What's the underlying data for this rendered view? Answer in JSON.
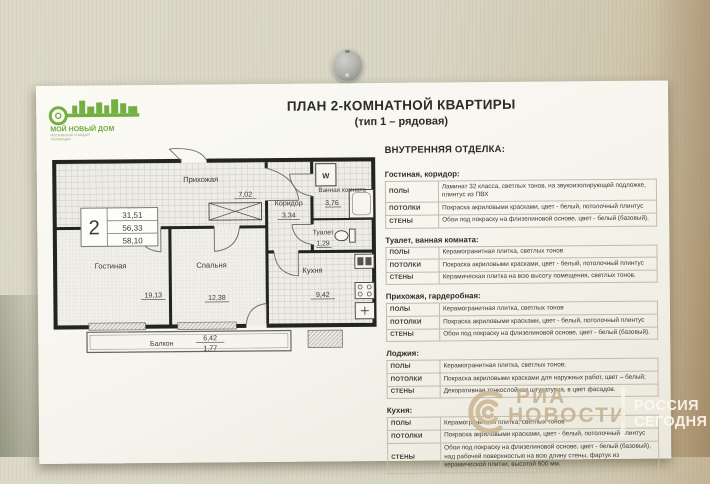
{
  "photo": {
    "watermark_left": {
      "line1": "РИА",
      "line2": "НОВОСТИ"
    },
    "watermark_right": {
      "line1": "РОССИЯ",
      "line2": "СЕГОДНЯ"
    }
  },
  "poster": {
    "logo": {
      "title": "МОЙ НОВЫЙ ДОМ",
      "subtitle_line1": "МОСКОВСКИЙ СТАНДАРТ",
      "subtitle_line2": "РЕНОВАЦИИ"
    },
    "title": "ПЛАН 2-КОМНАТНОЙ КВАРТИРЫ",
    "subtitle": "(тип 1 – рядовая)"
  },
  "plan": {
    "info_box": {
      "rooms": "2",
      "areas": [
        "31,51",
        "56,33",
        "58,10"
      ]
    },
    "washer_label": "W",
    "rooms": {
      "hallway": {
        "name": "Прихожая",
        "area": "7,02"
      },
      "corridor": {
        "name": "Коридор",
        "area": "3,34"
      },
      "bathroom": {
        "name": "Ванная комната",
        "area": "3,76"
      },
      "toilet": {
        "name": "Туалет",
        "area": "1,29"
      },
      "kitchen": {
        "name": "Кухня",
        "area": "9,42"
      },
      "living_room": {
        "name": "Гостиная",
        "area": "19,13"
      },
      "bedroom": {
        "name": "Спальня",
        "area": "12,38"
      },
      "balcony": {
        "name": "Балкон",
        "area_top": "6,42",
        "area_bottom": "1,77"
      }
    }
  },
  "finishes": {
    "title": "ВНУТРЕННЯЯ ОТДЕЛКА:",
    "row_labels": {
      "floors": "ПОЛЫ",
      "ceilings": "ПОТОЛКИ",
      "walls": "СТЕНЫ"
    },
    "sections": [
      {
        "title": "Гостиная, коридор:",
        "floors": "Ламинат 32 класса, светлых тонов, на звукоизолирующей подложке, плинтус из ПВХ",
        "ceilings": "Покраска акриловыми красками, цвет - белый, потолочный плинтус",
        "walls": "Обои под покраску на флизелиновой основе, цвет - белый (базовый)."
      },
      {
        "title": "Туалет, ванная комната:",
        "floors": "Керамогранитная плитка, светлых тонов",
        "ceilings": "Покраска акриловыми красками, цвет - белый, потолочный плинтус",
        "walls": "Керамическая плитка на всю высоту помещения, светлых тонов."
      },
      {
        "title": "Прихожая, гардеробная:",
        "floors": "Керамогранитная плитка, светлых тонов",
        "ceilings": "Покраска акриловыми красками, цвет - белый, потолочный плинтус",
        "walls": "Обои под покраску на флизелиновой основе, цвет - белый (базовый)."
      },
      {
        "title": "Лоджия:",
        "floors": "Керамогранитная плитка, светлых тонов;",
        "ceilings": "Покраска акриловыми красками для наружных работ, цвет – белый;",
        "walls": "Декоративная тонкослойная штукатурка, в цвет фасадов."
      },
      {
        "title": "Кухня:",
        "floors": "Керамогранитная плитка, светлых тонов",
        "ceilings": "Покраска акриловыми красками, цвет - белый, потолочный плинтус",
        "walls": "Обои под покраску на флизелиновой основе, цвет - белый (базовый), над рабочей поверхностью на всю длину стены, фартук из керамической плитки, высотой 600 мм."
      }
    ]
  },
  "colors": {
    "logo_green": "#74af41",
    "paper": "#f6f5ee",
    "wall": "#d8d5c4",
    "wall_dark": "#b29b77",
    "watermark_beige": "#c4af8e",
    "plan_wall_ink": "#23231f"
  }
}
